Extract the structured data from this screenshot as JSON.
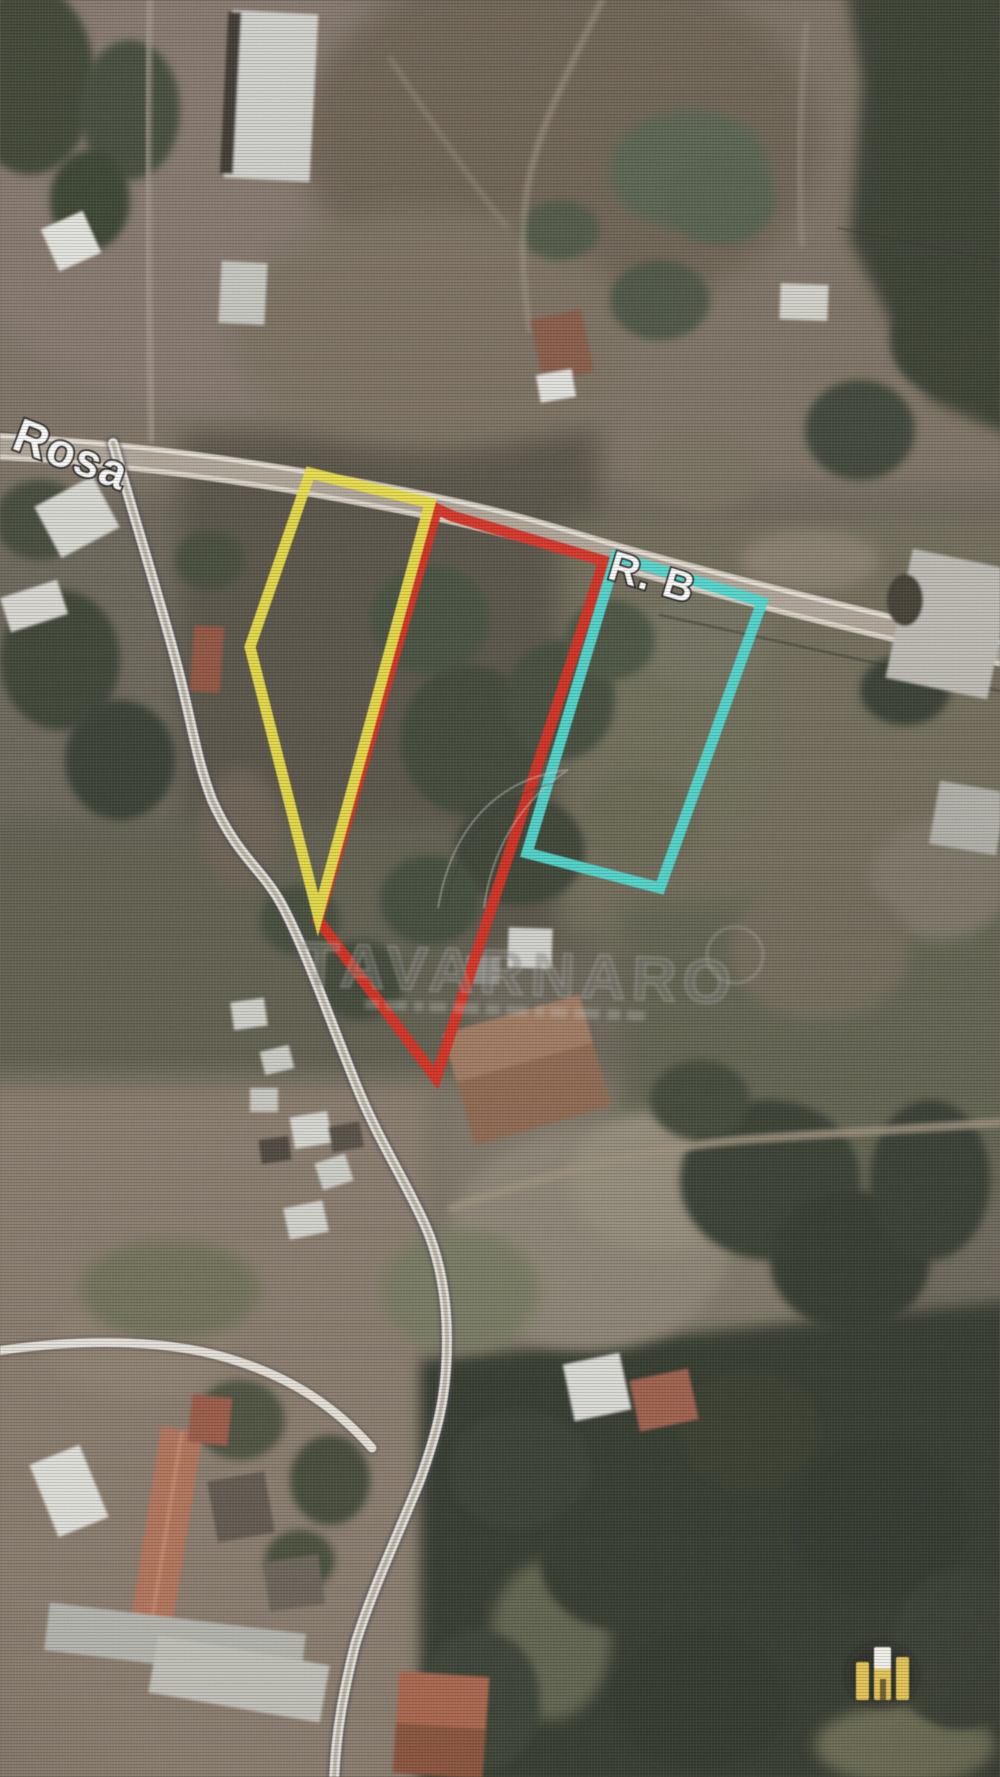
{
  "image": {
    "type": "satellite-aerial-photo",
    "description": "Aerial satellite view of rural land parcels outlined for sale, photographed from a screen"
  },
  "street_labels": [
    {
      "id": "rosa",
      "text": "Rosa"
    },
    {
      "id": "r-b",
      "text": "R. B"
    }
  ],
  "parcels": [
    {
      "id": "yellow-lot",
      "color": "#f2e32c",
      "points": "310,473 430,503 318,915 250,647"
    },
    {
      "id": "red-lot",
      "color": "#ee2413",
      "points": "452,516 604,561 436,1078 318,920 437,509"
    },
    {
      "id": "cyan-lot",
      "color": "#3be0d6",
      "points": "616,556 762,602 660,888 527,853"
    }
  ],
  "watermark": {
    "text": "TAVARNARO",
    "color": "rgba(128,126,118,0.42)"
  },
  "logo": {
    "name": "agency-emblem",
    "color": "#ecc53e"
  }
}
